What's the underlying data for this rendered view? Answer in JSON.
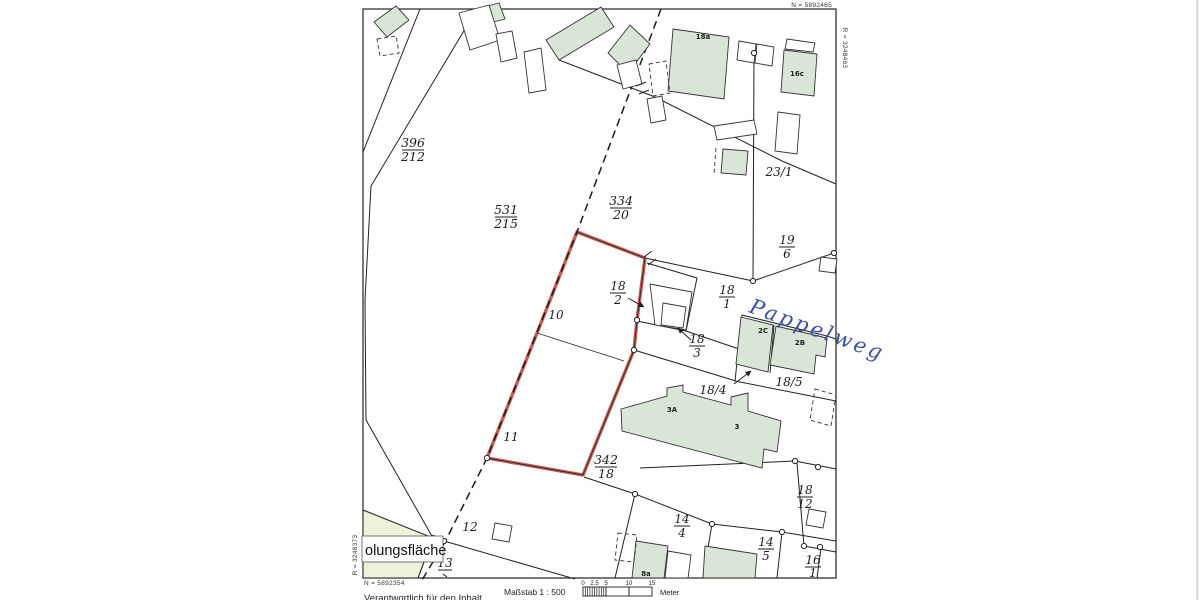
{
  "map": {
    "corner_coords": {
      "top_right_n": "N = 5892465",
      "right_edge_r": "R = 3248463",
      "bottom_left_n": "N = 5892354",
      "left_edge_r": "R = 3248373"
    },
    "street_name": "Pappelweg",
    "area_label": "olungsfläche",
    "fractions": [
      {
        "id": "396-212",
        "num": "396",
        "den": "212"
      },
      {
        "id": "531-215",
        "num": "531",
        "den": "215"
      },
      {
        "id": "334-20",
        "num": "334",
        "den": "20"
      },
      {
        "id": "19-6",
        "num": "19",
        "den": "6"
      },
      {
        "id": "18-2",
        "num": "18",
        "den": "2"
      },
      {
        "id": "18-1",
        "num": "18",
        "den": "1"
      },
      {
        "id": "18-3",
        "num": "18",
        "den": "3"
      },
      {
        "id": "342-18",
        "num": "342",
        "den": "18"
      },
      {
        "id": "18-12",
        "num": "18",
        "den": "12"
      },
      {
        "id": "14-4",
        "num": "14",
        "den": "4"
      },
      {
        "id": "14-5",
        "num": "14",
        "den": "5"
      },
      {
        "id": "16-1",
        "num": "16",
        "den": "1"
      },
      {
        "id": "13",
        "num": "13",
        "den": ""
      }
    ],
    "plain_labels": [
      {
        "id": "23-1",
        "text": "23/1"
      },
      {
        "id": "18-4",
        "text": "18/4"
      },
      {
        "id": "18-5",
        "text": "18/5"
      },
      {
        "id": "10",
        "text": "10"
      },
      {
        "id": "11",
        "text": "11"
      },
      {
        "id": "12",
        "text": "12"
      }
    ],
    "building_labels": [
      {
        "text": "18a"
      },
      {
        "text": "16c"
      },
      {
        "text": "2C"
      },
      {
        "text": "2B"
      },
      {
        "text": "3A"
      },
      {
        "text": "3"
      },
      {
        "text": "8a"
      }
    ],
    "footer": {
      "scale_label": "Maßstab 1 : 500",
      "scale_ticks": [
        "0",
        "2.5",
        "5",
        "10",
        "15"
      ],
      "unit_label": "Meter",
      "responsible_note": "Verantwortlich für den Inhalt"
    },
    "colors": {
      "building_green": "#d9e5d7",
      "area_green": "#eef2da",
      "parcel_red": "#c2443a",
      "ink_blue": "#3a50a8"
    }
  }
}
